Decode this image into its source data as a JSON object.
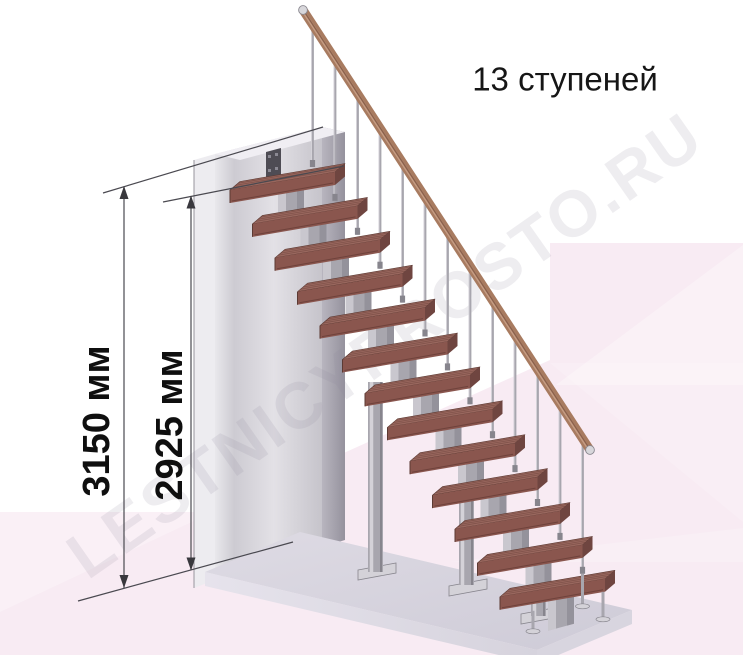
{
  "title": {
    "text": "13 ступеней"
  },
  "watermark": {
    "text": "LESTNICYPROSTO.RU"
  },
  "dimensions": [
    {
      "id": "total-height",
      "label": "3150 мм",
      "value_mm": 3150,
      "orientation": "vertical"
    },
    {
      "id": "upper-height",
      "label": "2925 мм",
      "value_mm": 2925,
      "orientation": "vertical"
    }
  ],
  "stair": {
    "steps_count": 13,
    "type": "modular-straight-flight",
    "has_handrail": true,
    "balusters_per_step": 1
  },
  "colors": {
    "background": "#ffffff",
    "background_pink": "#f8ebf3",
    "wall_front": "#d9d7dd",
    "wall_side": "#aaa7b2",
    "floor_top": "#d5d2dc",
    "floor_front": "#e3e0e9",
    "tread_top": "#99675e",
    "tread_front": "#8a564e",
    "tread_side": "#6f4540",
    "tread_edge_dark": "#5c3a33",
    "metal": "#a8a6ae",
    "metal_light": "#d4d2d8",
    "metal_dark": "#87858d",
    "rail": "#a87b60",
    "rail_highlight": "#c59c83",
    "rail_shadow": "#7c523e",
    "rail_cap": "#d8d7db",
    "bracket": "#4e4c54",
    "dimension_line": "#4a4950",
    "arrow": "#39383d",
    "text": "#0f0f0f",
    "watermark_gray": "#8d8797"
  }
}
